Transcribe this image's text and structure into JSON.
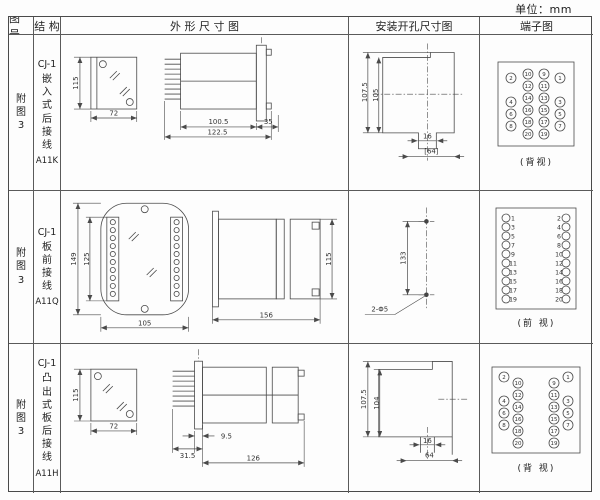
{
  "unit_label": "单位：mm",
  "headers": {
    "fig": "图 号",
    "structure": "结 构",
    "outline": "外 形 尺 寸 图",
    "install": "安装开孔尺寸图",
    "terminal": "端子图"
  },
  "rows": [
    {
      "fig": "附图3",
      "model": "CJ-1",
      "structure": "嵌入式后接线",
      "code": "A11K",
      "dims": {
        "front_h": "115",
        "front_w": "72",
        "body": "100.5",
        "overall": "122.5",
        "panel": "35",
        "cut_outer": "107.5",
        "cut_inner": "105",
        "slot": "16",
        "span": "[64]"
      },
      "terminal_caption": "(背视)",
      "terminals": {
        "r": 5,
        "items": [
          {
            "n": "2",
            "c": [
              31,
              20
            ]
          },
          {
            "n": "10",
            "c": [
              48,
              16
            ]
          },
          {
            "n": "9",
            "c": [
              64,
              16
            ]
          },
          {
            "n": "1",
            "c": [
              80,
              20
            ]
          },
          {
            "n": "12",
            "c": [
              48,
              28
            ]
          },
          {
            "n": "11",
            "c": [
              64,
              28
            ]
          },
          {
            "n": "4",
            "c": [
              31,
              44
            ]
          },
          {
            "n": "14",
            "c": [
              48,
              40
            ]
          },
          {
            "n": "13",
            "c": [
              64,
              40
            ]
          },
          {
            "n": "3",
            "c": [
              80,
              44
            ]
          },
          {
            "n": "6",
            "c": [
              31,
              56
            ]
          },
          {
            "n": "16",
            "c": [
              48,
              52
            ]
          },
          {
            "n": "15",
            "c": [
              64,
              52
            ]
          },
          {
            "n": "5",
            "c": [
              80,
              56
            ]
          },
          {
            "n": "8",
            "c": [
              31,
              68
            ]
          },
          {
            "n": "18",
            "c": [
              48,
              64
            ]
          },
          {
            "n": "17",
            "c": [
              64,
              64
            ]
          },
          {
            "n": "7",
            "c": [
              80,
              68
            ]
          },
          {
            "n": "20",
            "c": [
              48,
              76
            ]
          },
          {
            "n": "19",
            "c": [
              64,
              76
            ]
          }
        ]
      }
    },
    {
      "fig": "附图3",
      "model": "CJ-1",
      "structure": "板前接线",
      "code": "A11Q",
      "dims": {
        "front_h": "149",
        "front_inner": "125",
        "front_w": "105",
        "side_len": "156",
        "side_h": "115",
        "hole_span": "133",
        "hole_label": "2-Φ5"
      },
      "terminal_caption": "(前 视)",
      "terminals": {
        "r": 4,
        "items": [
          {
            "c": [
              26,
              13
            ]
          },
          {
            "c": [
              26,
              22
            ]
          },
          {
            "c": [
              26,
              31
            ]
          },
          {
            "c": [
              26,
              40
            ]
          },
          {
            "c": [
              26,
              49
            ]
          },
          {
            "c": [
              26,
              58
            ]
          },
          {
            "c": [
              26,
              67
            ]
          },
          {
            "c": [
              26,
              76
            ]
          },
          {
            "c": [
              26,
              85
            ]
          },
          {
            "c": [
              26,
              94
            ]
          },
          {
            "c": [
              86,
              13
            ]
          },
          {
            "c": [
              86,
              22
            ]
          },
          {
            "c": [
              86,
              31
            ]
          },
          {
            "c": [
              86,
              40
            ]
          },
          {
            "c": [
              86,
              49
            ]
          },
          {
            "c": [
              86,
              58
            ]
          },
          {
            "c": [
              86,
              67
            ]
          },
          {
            "c": [
              86,
              76
            ]
          },
          {
            "c": [
              86,
              85
            ]
          },
          {
            "c": [
              86,
              94
            ]
          },
          {
            "t": [
              33,
              15.5
            ],
            "n": "1",
            "a": "start"
          },
          {
            "t": [
              33,
              24.5
            ],
            "n": "3",
            "a": "start"
          },
          {
            "t": [
              33,
              33.5
            ],
            "n": "5",
            "a": "start"
          },
          {
            "t": [
              33,
              42.5
            ],
            "n": "7",
            "a": "start"
          },
          {
            "t": [
              33,
              51.5
            ],
            "n": "9",
            "a": "start"
          },
          {
            "t": [
              33,
              60.5
            ],
            "n": "11",
            "a": "start"
          },
          {
            "t": [
              33,
              69.5
            ],
            "n": "13",
            "a": "start"
          },
          {
            "t": [
              33,
              78.5
            ],
            "n": "15",
            "a": "start"
          },
          {
            "t": [
              33,
              87.5
            ],
            "n": "17",
            "a": "start"
          },
          {
            "t": [
              33,
              96.5
            ],
            "n": "19",
            "a": "start"
          },
          {
            "t": [
              79,
              15.5
            ],
            "n": "2",
            "a": "end"
          },
          {
            "t": [
              79,
              24.5
            ],
            "n": "4",
            "a": "end"
          },
          {
            "t": [
              79,
              33.5
            ],
            "n": "6",
            "a": "end"
          },
          {
            "t": [
              79,
              42.5
            ],
            "n": "8",
            "a": "end"
          },
          {
            "t": [
              79,
              51.5
            ],
            "n": "10",
            "a": "end"
          },
          {
            "t": [
              79,
              60.5
            ],
            "n": "12",
            "a": "end"
          },
          {
            "t": [
              79,
              69.5
            ],
            "n": "14",
            "a": "end"
          },
          {
            "t": [
              79,
              78.5
            ],
            "n": "16",
            "a": "end"
          },
          {
            "t": [
              79,
              87.5
            ],
            "n": "18",
            "a": "end"
          },
          {
            "t": [
              79,
              96.5
            ],
            "n": "20",
            "a": "end"
          }
        ]
      }
    },
    {
      "fig": "附图3",
      "model": "CJ-1",
      "structure": "凸出式板后接线",
      "code": "A11H",
      "dims": {
        "front_h": "115",
        "front_w": "72",
        "pins": "31.5",
        "flange": "9.5",
        "body": "126",
        "cut_outer": "107.5",
        "cut_inner": "104",
        "slot": "16",
        "span": "64"
      },
      "terminal_caption": "(背 视)",
      "terminals": {
        "r": 5,
        "items": [
          {
            "n": "2",
            "c": [
              24,
              13
            ]
          },
          {
            "n": "4",
            "c": [
              24,
              37
            ]
          },
          {
            "n": "6",
            "c": [
              24,
              49
            ]
          },
          {
            "n": "8",
            "c": [
              24,
              61
            ]
          },
          {
            "n": "10",
            "c": [
              38,
              19
            ]
          },
          {
            "n": "12",
            "c": [
              38,
              31
            ]
          },
          {
            "n": "14",
            "c": [
              38,
              43
            ]
          },
          {
            "n": "16",
            "c": [
              38,
              55
            ]
          },
          {
            "n": "18",
            "c": [
              38,
              67
            ]
          },
          {
            "n": "20",
            "c": [
              38,
              79
            ]
          },
          {
            "n": "9",
            "c": [
              74,
              19
            ]
          },
          {
            "n": "11",
            "c": [
              74,
              31
            ]
          },
          {
            "n": "13",
            "c": [
              74,
              43
            ]
          },
          {
            "n": "15",
            "c": [
              74,
              55
            ]
          },
          {
            "n": "17",
            "c": [
              74,
              67
            ]
          },
          {
            "n": "19",
            "c": [
              74,
              79
            ]
          },
          {
            "n": "1",
            "c": [
              88,
              13
            ]
          },
          {
            "n": "3",
            "c": [
              88,
              37
            ]
          },
          {
            "n": "5",
            "c": [
              88,
              49
            ]
          },
          {
            "n": "7",
            "c": [
              88,
              61
            ]
          }
        ]
      }
    }
  ]
}
